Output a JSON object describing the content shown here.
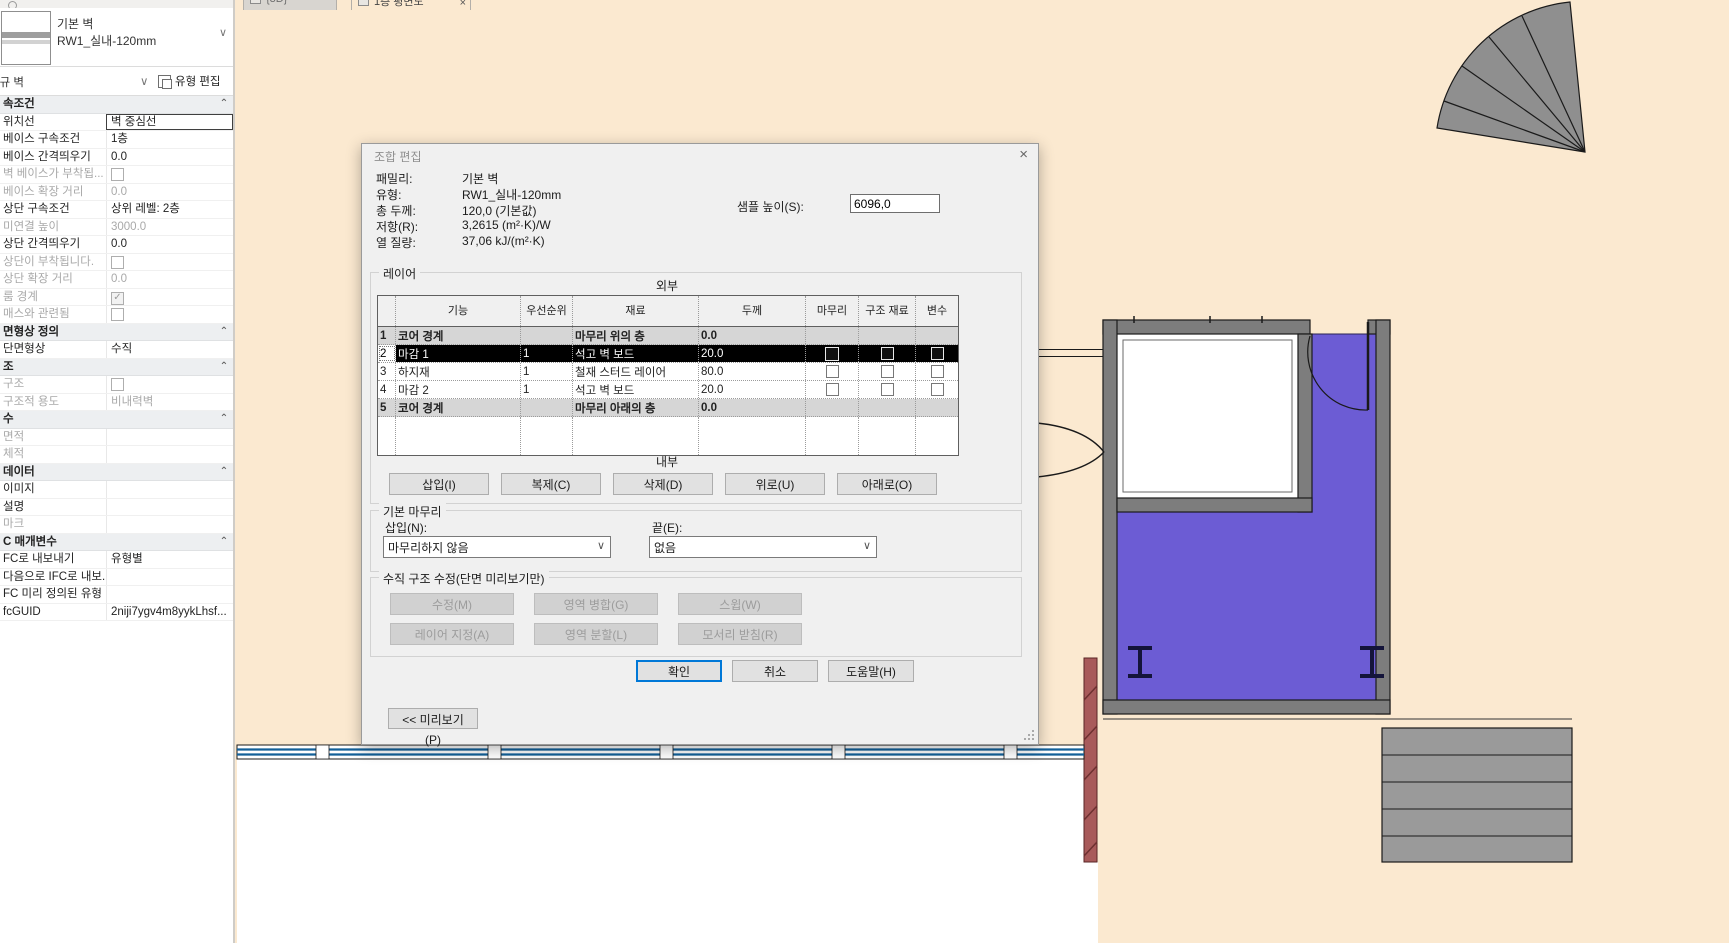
{
  "tabs": {
    "items": [
      {
        "label": "{3D}",
        "active": false
      },
      {
        "label": "1층 평면도",
        "active": true,
        "close_glyph": "×"
      }
    ]
  },
  "properties_panel": {
    "type_name_line1": "기본 벽",
    "type_name_line2": "RW1_실내-120mm",
    "selector_value": "신규 벽",
    "edit_type_label": "유형 편집",
    "dropdown_glyph": "∨",
    "section_chevron": "⌃",
    "rows": [
      {
        "kind": "section",
        "label": "속조건"
      },
      {
        "kind": "text",
        "label": "위치선",
        "value": "벽 중심선",
        "editing": true
      },
      {
        "kind": "text",
        "label": "베이스 구속조건",
        "value": "1층"
      },
      {
        "kind": "text",
        "label": "베이스 간격띄우기",
        "value": "0.0"
      },
      {
        "kind": "checkbox",
        "label": "벽 베이스가 부착됩...",
        "checked": false,
        "muted": true
      },
      {
        "kind": "text",
        "label": "베이스 확장 거리",
        "value": "0.0",
        "muted": true
      },
      {
        "kind": "text",
        "label": "상단 구속조건",
        "value": "상위 레벨: 2층"
      },
      {
        "kind": "text",
        "label": "미연결 높이",
        "value": "3000.0",
        "muted": true
      },
      {
        "kind": "text",
        "label": "상단 간격띄우기",
        "value": "0.0"
      },
      {
        "kind": "checkbox",
        "label": "상단이 부착됩니다.",
        "checked": false,
        "muted": true
      },
      {
        "kind": "text",
        "label": "상단 확장 거리",
        "value": "0.0",
        "muted": true
      },
      {
        "kind": "checkbox",
        "label": "룸 경계",
        "checked": true,
        "muted": true
      },
      {
        "kind": "checkbox",
        "label": "매스와 관련됨",
        "checked": false,
        "muted": true
      },
      {
        "kind": "section",
        "label": "면형상 정의"
      },
      {
        "kind": "text",
        "label": "단면형상",
        "value": "수직"
      },
      {
        "kind": "section",
        "label": "조"
      },
      {
        "kind": "checkbox",
        "label": "구조",
        "checked": false,
        "muted": true
      },
      {
        "kind": "text",
        "label": "구조적 용도",
        "value": "비내력벽",
        "muted": true
      },
      {
        "kind": "section",
        "label": "수"
      },
      {
        "kind": "text",
        "label": "면적",
        "value": "",
        "muted": true
      },
      {
        "kind": "text",
        "label": "체적",
        "value": "",
        "muted": true
      },
      {
        "kind": "section",
        "label": "데이터"
      },
      {
        "kind": "text",
        "label": "이미지",
        "value": ""
      },
      {
        "kind": "text",
        "label": "설명",
        "value": ""
      },
      {
        "kind": "text",
        "label": "마크",
        "value": "",
        "muted": true
      },
      {
        "kind": "section",
        "label": "C 매개변수"
      },
      {
        "kind": "text",
        "label": "FC로 내보내기",
        "value": "유형별"
      },
      {
        "kind": "text",
        "label": "다음으로 IFC로 내보...",
        "value": ""
      },
      {
        "kind": "text",
        "label": "FC 미리 정의된 유형",
        "value": ""
      },
      {
        "kind": "text",
        "label": "fcGUID",
        "value": "2niji7ygv4m8yykLhsf..."
      }
    ]
  },
  "dialog": {
    "title": "조합 편집",
    "close_glyph": "×",
    "info": {
      "family_label": "패밀리:",
      "family_value": "기본 벽",
      "type_label": "유형:",
      "type_value": "RW1_실내-120mm",
      "thickness_label": "총 두께:",
      "thickness_value": "120,0 (기본값)",
      "resistance_label": "저항(R):",
      "resistance_value": "3,2615 (m²·K)/W",
      "heat_label": "열 질량:",
      "heat_value": "37,06 kJ/(m²·K)",
      "sample_height_label": "샘플 높이(S):",
      "sample_height_value": "6096,0"
    },
    "layers": {
      "group_label": "레이어",
      "exterior_label": "외부",
      "interior_label": "내부",
      "columns": [
        "",
        "기능",
        "우선순위",
        "재료",
        "두께",
        "마무리",
        "구조 재료",
        "변수"
      ],
      "rows": [
        {
          "num": "1",
          "function": "코어 경계",
          "priority": "",
          "material": "마무리 위의 층",
          "thickness": "0.0",
          "kind": "core",
          "checks": false
        },
        {
          "num": "2",
          "function": "마감 1",
          "priority": "1",
          "material": "석고 벽 보드",
          "thickness": "20.0",
          "kind": "selected",
          "checks": true
        },
        {
          "num": "3",
          "function": "하지재",
          "priority": "1",
          "material": "철재 스터드 레이어",
          "thickness": "80.0",
          "kind": "normal",
          "checks": true
        },
        {
          "num": "4",
          "function": "마감 2",
          "priority": "1",
          "material": "석고 벽 보드",
          "thickness": "20.0",
          "kind": "normal",
          "checks": true
        },
        {
          "num": "5",
          "function": "코어 경계",
          "priority": "",
          "material": "마무리 아래의 층",
          "thickness": "0.0",
          "kind": "core",
          "checks": false
        },
        {
          "num": "",
          "function": "",
          "priority": "",
          "material": "",
          "thickness": "",
          "kind": "empty",
          "checks": false
        }
      ],
      "buttons": [
        "삽입(I)",
        "복제(C)",
        "삭제(D)",
        "위로(U)",
        "아래로(O)"
      ]
    },
    "default_wrap": {
      "group_label": "기본 마무리",
      "insert_label": "삽입(N):",
      "insert_value": "마무리하지 않음",
      "end_label": "끝(E):",
      "end_value": "없음"
    },
    "vertical_structure": {
      "group_label": "수직 구조 수정(단면 미리보기만)",
      "buttons": [
        "수정(M)",
        "영역 병합(G)",
        "스윕(W)",
        "레이어 지정(A)",
        "영역 분할(L)",
        "모서리 받침(R)"
      ]
    },
    "footer": {
      "ok_label": "확인",
      "cancel_label": "취소",
      "help_label": "도움말(H)",
      "preview_label": "<< 미리보기(P)"
    }
  },
  "colors": {
    "accent": "#0078d7",
    "canvas": "#fbe9d0",
    "room_fill": "#6c5cd4",
    "wall_gray": "#7d7d7d",
    "curtain_blue": "#136099",
    "red_wall": "#a85a5a",
    "selection_black": "#000000"
  }
}
